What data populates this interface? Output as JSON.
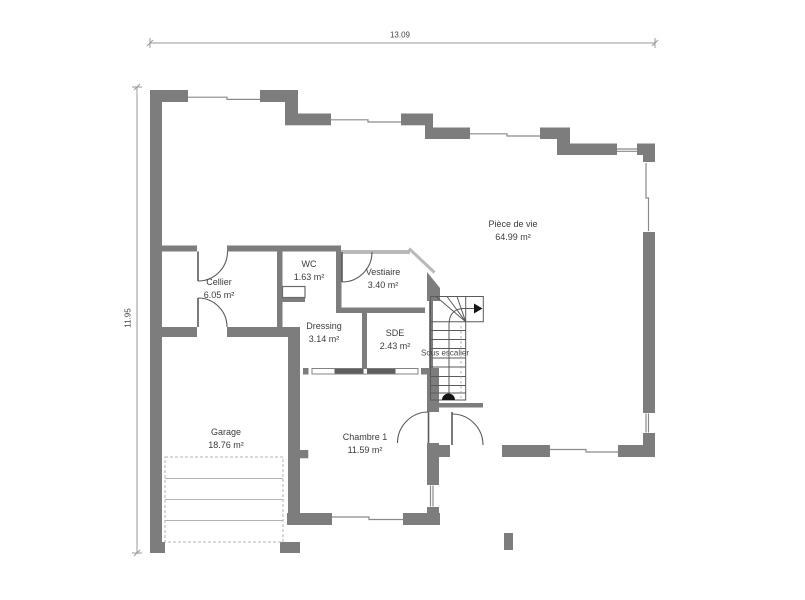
{
  "plan_title": "Floor plan",
  "dimensions": {
    "top_width": "13.09",
    "left_height": "11.95"
  },
  "rooms": [
    {
      "id": "piece-de-vie",
      "name": "Pièce de vie",
      "area": "64.99 m²"
    },
    {
      "id": "cellier",
      "name": "Cellier",
      "area": "6.05 m²"
    },
    {
      "id": "wc",
      "name": "WC",
      "area": "1.63 m²"
    },
    {
      "id": "vestiaire",
      "name": "Vestiaire",
      "area": "3.40 m²"
    },
    {
      "id": "dressing",
      "name": "Dressing",
      "area": "3.14 m²"
    },
    {
      "id": "sde",
      "name": "SDE",
      "area": "2.43 m²"
    },
    {
      "id": "garage",
      "name": "Garage",
      "area": "18.76 m²"
    },
    {
      "id": "chambre-1",
      "name": "Chambre 1",
      "area": "11.59 m²"
    }
  ],
  "annotations": {
    "under_stairs": "Sous escalier"
  },
  "colors": {
    "wall": "#7d7d7d",
    "wall_light": "#b9b9b9",
    "line": "#5a5a5a",
    "window_line": "#8a8a8a",
    "dimension": "#999999",
    "text": "#3c3c3c",
    "garage_door": "#b3b3b3"
  }
}
